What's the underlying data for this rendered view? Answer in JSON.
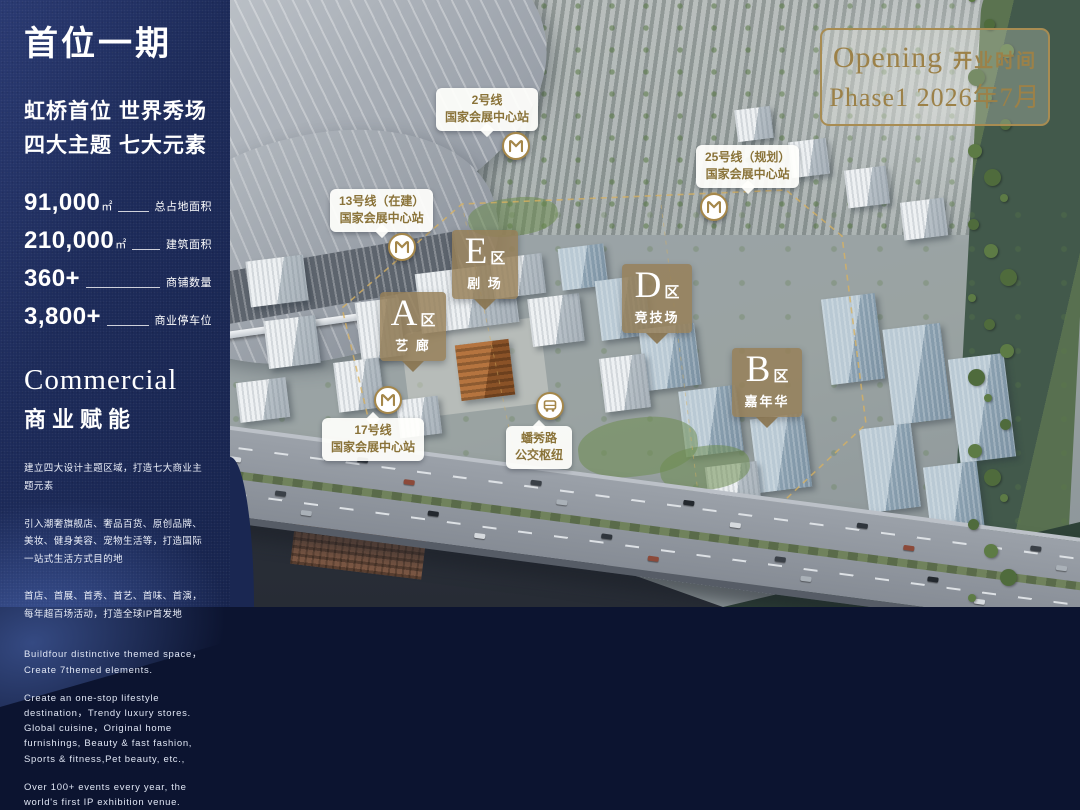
{
  "sidebar": {
    "title": "首位一期",
    "subtitle_line1": "虹桥首位 世界秀场",
    "subtitle_line2": "四大主题 七大元素",
    "stats": [
      {
        "value": "91,000",
        "unit": "㎡",
        "label": "总占地面积"
      },
      {
        "value": "210,000",
        "unit": "㎡",
        "label": "建筑面积"
      },
      {
        "value": "360+",
        "unit": "",
        "label": "商铺数量"
      },
      {
        "value": "3,800+",
        "unit": "",
        "label": "商业停车位"
      }
    ],
    "commercial": {
      "heading_en": "Commercial",
      "heading_zh": "商业赋能",
      "para_zh_1": "建立四大设计主题区域，打造七大商业主题元素",
      "para_zh_2": "引入潮奢旗舰店、奢品百货、原创品牌、美妆、健身美容、宠物生活等，打造国际一站式生活方式目的地",
      "para_zh_3": "首店、首展、首秀、首艺、首味、首演，每年超百场活动，打造全球IP首发地",
      "para_en_1": "Buildfour distinctive themed space，Create 7themed elements.",
      "para_en_2": "Create an one-stop lifestyle destination，Trendy luxury stores. Global cuisine，Original home furnishings, Beauty & fast fashion, Sports & fitness,Pet beauty, etc.,",
      "para_en_3": "Over 100+ events every year, the world's first IP exhibition venue."
    }
  },
  "badge": {
    "opening_en": "Opening",
    "opening_zh": "开业时间",
    "phase_line": "Phase1 2026年7月"
  },
  "zones": [
    {
      "letter": "A",
      "suffix": "区",
      "name": "艺 廊"
    },
    {
      "letter": "B",
      "suffix": "区",
      "name": "嘉年华"
    },
    {
      "letter": "D",
      "suffix": "区",
      "name": "竞技场"
    },
    {
      "letter": "E",
      "suffix": "区",
      "name": "剧 场"
    }
  ],
  "stations": [
    {
      "line1": "2号线",
      "line2": "国家会展中心站",
      "icon": "metro-icon"
    },
    {
      "line1": "13号线（在建）",
      "line2": "国家会展中心站",
      "icon": "metro-icon"
    },
    {
      "line1": "25号线（规划）",
      "line2": "国家会展中心站",
      "icon": "metro-icon"
    },
    {
      "line1": "17号线",
      "line2": "国家会展中心站",
      "icon": "metro-icon"
    },
    {
      "line1": "蟠秀路",
      "line2": "公交枢纽",
      "icon": "bus-icon"
    }
  ],
  "colors": {
    "navy": "#1D2B5A",
    "gold": "#A88C52",
    "label_gold": "#8A7339",
    "zone_bronze": "#96805A",
    "site_outline_gold": "#D9B25F"
  }
}
